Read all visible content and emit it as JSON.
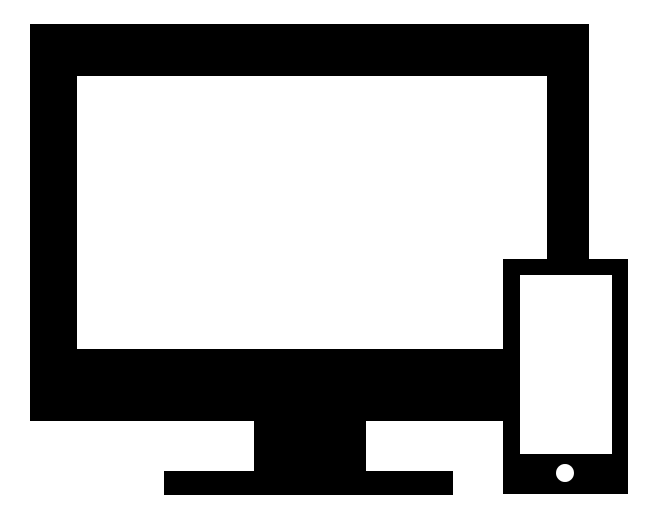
{
  "icon": {
    "name": "responsive-devices-icon",
    "monitor_label": "desktop-monitor",
    "phone_label": "smartphone",
    "colors": {
      "foreground": "#000000",
      "background": "#ffffff"
    }
  }
}
